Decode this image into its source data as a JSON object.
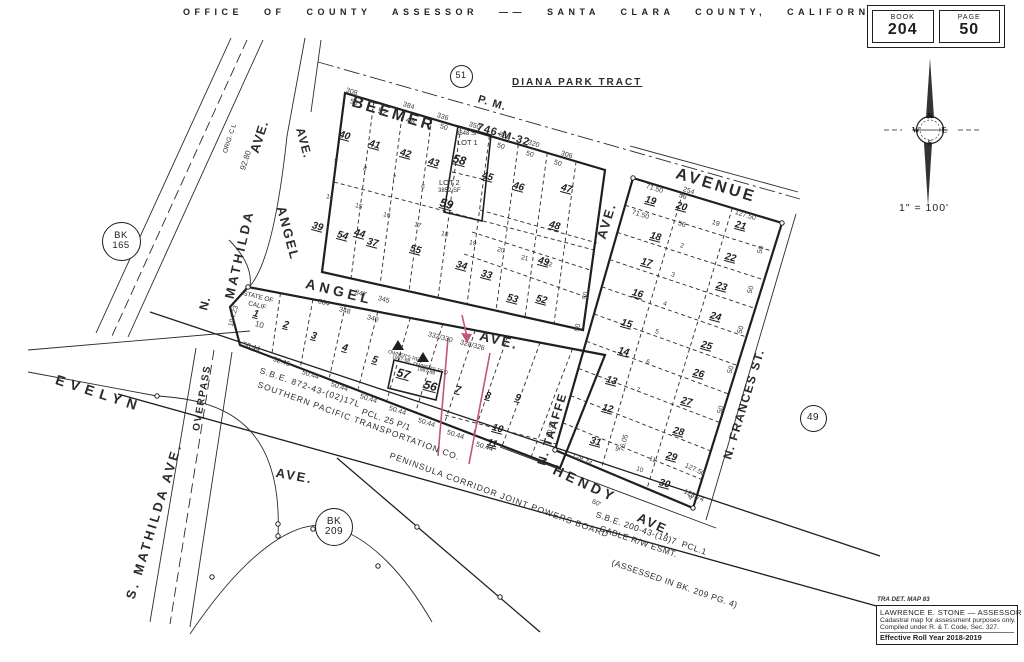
{
  "header": {
    "title": "OFFICE OF COUNTY ASSESSOR —— SANTA CLARA COUNTY, CALIFORNIA"
  },
  "book_page": {
    "book_label": "BOOK",
    "book_value": "204",
    "page_label": "PAGE",
    "page_value": "50"
  },
  "compass": {
    "letters": [
      "N",
      "E",
      "S",
      "W"
    ],
    "scale": "1\" = 100'"
  },
  "stamp": {
    "tra": "TRA DET. MAP 83",
    "line1": "LAWRENCE E. STONE — ASSESSOR",
    "line2": "Cadastral map for assessment purposes only.",
    "line3": "Compiled under R. & T. Code, Sec. 327.",
    "line4": "Effective Roll Year 2018-2019"
  },
  "colors": {
    "ink": "#1f1f1f",
    "accent": "#c2557f"
  },
  "map": {
    "streets": [
      {
        "t": "BEEMER",
        "x": 352,
        "y": 94,
        "r": 17,
        "s": 16,
        "ls": 3
      },
      {
        "t": "P. M.",
        "x": 478,
        "y": 94,
        "r": 17,
        "s": 11,
        "ls": 1
      },
      {
        "t": "746-M-32",
        "x": 477,
        "y": 122,
        "r": 17,
        "s": 11,
        "ls": 1
      },
      {
        "t": "DIANA PARK TRACT",
        "x": 512,
        "y": 78,
        "r": 0,
        "s": 10,
        "ls": 2,
        "u": 1
      },
      {
        "t": "AVENUE",
        "x": 676,
        "y": 166,
        "r": 17,
        "s": 16,
        "ls": 3
      },
      {
        "t": "AVE.",
        "x": 601,
        "y": 232,
        "r": -73,
        "s": 13,
        "ls": 2
      },
      {
        "t": "AVE.",
        "x": 300,
        "y": 122,
        "r": 75,
        "s": 12,
        "ls": 1
      },
      {
        "t": "ANGEL",
        "x": 281,
        "y": 200,
        "r": 75,
        "s": 13,
        "ls": 2
      },
      {
        "t": "ANGEL",
        "x": 306,
        "y": 276,
        "r": 14,
        "s": 14,
        "ls": 4
      },
      {
        "t": "AVE.",
        "x": 480,
        "y": 328,
        "r": 14,
        "s": 14,
        "ls": 2
      },
      {
        "t": "N.",
        "x": 203,
        "y": 304,
        "r": -75,
        "s": 12,
        "ls": 1
      },
      {
        "t": "MATHILDA",
        "x": 229,
        "y": 292,
        "r": -77,
        "s": 13,
        "ls": 3
      },
      {
        "t": "AVE.",
        "x": 254,
        "y": 146,
        "r": -72,
        "s": 13,
        "ls": 1
      },
      {
        "t": "EVELYN",
        "x": 56,
        "y": 372,
        "r": 18,
        "s": 14,
        "ls": 6
      },
      {
        "t": "S. MATHILDA AVE.",
        "x": 130,
        "y": 592,
        "r": -73,
        "s": 13,
        "ls": 3
      },
      {
        "t": "OVERPASS",
        "x": 197,
        "y": 426,
        "r": -80,
        "s": 10,
        "ls": 1.5
      },
      {
        "t": "AVE.",
        "x": 276,
        "y": 466,
        "r": 10,
        "s": 13,
        "ls": 2
      },
      {
        "t": "HENDY",
        "x": 554,
        "y": 462,
        "r": 25,
        "s": 14,
        "ls": 4
      },
      {
        "t": "AVE.",
        "x": 638,
        "y": 510,
        "r": 25,
        "s": 13,
        "ls": 2
      },
      {
        "t": "N. TAAFFE",
        "x": 541,
        "y": 459,
        "r": -73,
        "s": 12,
        "ls": 1.5
      },
      {
        "t": "N. FRANCES ST.",
        "x": 727,
        "y": 453,
        "r": -73,
        "s": 12,
        "ls": 1.5
      }
    ],
    "notes": [
      {
        "t": "S.B.E. 872-43-(02)17L",
        "x": 260,
        "y": 366,
        "r": 19,
        "s": 8.5,
        "ls": 1
      },
      {
        "t": "SOUTHERN PACIFIC TRANSPORTATION CO.",
        "x": 258,
        "y": 380,
        "r": 20,
        "s": 8.5,
        "ls": 1
      },
      {
        "t": "PCL. 25 P/1",
        "x": 362,
        "y": 407,
        "r": 19,
        "s": 8.5,
        "ls": 0.5
      },
      {
        "t": "PENINSULA CORRIDOR JOINT POWERS BOARD",
        "x": 390,
        "y": 451,
        "r": 20,
        "s": 8.5,
        "ls": 1
      },
      {
        "t": "S.B.E. 200-43-(18)7  PCL.1",
        "x": 596,
        "y": 510,
        "r": 19,
        "s": 8.5,
        "ls": 0.5
      },
      {
        "t": "CABLE R/W ESMT.",
        "x": 600,
        "y": 524,
        "r": 19,
        "s": 8.5,
        "ls": 0.5
      },
      {
        "t": "(ASSESSED IN BK. 209 PG. 4)",
        "x": 612,
        "y": 558,
        "r": 19,
        "s": 8.5,
        "ls": 0.5
      },
      {
        "t": "STATE OF",
        "x": 243,
        "y": 291,
        "r": 14,
        "s": 6.5
      },
      {
        "t": "CALIF",
        "x": 248,
        "y": 301,
        "r": 14,
        "s": 6.5
      },
      {
        "t": "OWNER'S REQ",
        "x": 388,
        "y": 350,
        "r": 15,
        "s": 5
      },
      {
        "t": "1987-88",
        "x": 392,
        "y": 355,
        "r": 15,
        "s": 5
      },
      {
        "t": "OWNER'S REQ",
        "x": 413,
        "y": 362,
        "r": 15,
        "s": 5
      },
      {
        "t": "1987-88",
        "x": 417,
        "y": 367,
        "r": 15,
        "s": 5
      },
      {
        "t": "LOT 1",
        "x": 457,
        "y": 139,
        "r": 0,
        "s": 7.5
      },
      {
        "t": "3648 SF",
        "x": 456,
        "y": 131,
        "r": 0,
        "s": 6
      },
      {
        "t": "LOT 2",
        "x": 439,
        "y": 179,
        "r": 0,
        "s": 7.5
      },
      {
        "t": "3852 SF",
        "x": 438,
        "y": 188,
        "r": 0,
        "s": 6
      },
      {
        "t": "ORIG. C L",
        "x": 226,
        "y": 150,
        "r": -72,
        "s": 6.5
      }
    ],
    "parcels": [
      {
        "t": "40",
        "x": 339,
        "y": 130
      },
      {
        "t": "41",
        "x": 369,
        "y": 139
      },
      {
        "t": "42",
        "x": 400,
        "y": 148
      },
      {
        "t": "43",
        "x": 428,
        "y": 157
      },
      {
        "t": "58",
        "x": 453,
        "y": 152,
        "s": 12
      },
      {
        "t": "45",
        "x": 482,
        "y": 171
      },
      {
        "t": "46",
        "x": 513,
        "y": 181
      },
      {
        "t": "47",
        "x": 561,
        "y": 183
      },
      {
        "t": "48",
        "x": 549,
        "y": 220
      },
      {
        "t": "49",
        "x": 538,
        "y": 256
      },
      {
        "t": "39",
        "x": 312,
        "y": 221
      },
      {
        "t": "54",
        "x": 337,
        "y": 230
      },
      {
        "t": "44",
        "x": 354,
        "y": 228
      },
      {
        "t": "37",
        "x": 367,
        "y": 237
      },
      {
        "t": "55",
        "x": 410,
        "y": 244
      },
      {
        "t": "34",
        "x": 456,
        "y": 260
      },
      {
        "t": "33",
        "x": 481,
        "y": 269
      },
      {
        "t": "53",
        "x": 507,
        "y": 293
      },
      {
        "t": "52",
        "x": 536,
        "y": 294
      },
      {
        "t": "59",
        "x": 440,
        "y": 196,
        "s": 12
      },
      {
        "t": "1",
        "x": 253,
        "y": 309
      },
      {
        "t": "2",
        "x": 283,
        "y": 320
      },
      {
        "t": "3",
        "x": 311,
        "y": 331
      },
      {
        "t": "4",
        "x": 342,
        "y": 343
      },
      {
        "t": "5",
        "x": 372,
        "y": 355
      },
      {
        "t": "57",
        "x": 397,
        "y": 366,
        "s": 12
      },
      {
        "t": "56",
        "x": 424,
        "y": 378,
        "s": 12
      },
      {
        "t": "7",
        "x": 455,
        "y": 385
      },
      {
        "t": "8",
        "x": 485,
        "y": 391
      },
      {
        "t": "9",
        "x": 515,
        "y": 393
      },
      {
        "t": "10",
        "x": 492,
        "y": 423
      },
      {
        "t": "11",
        "x": 487,
        "y": 438
      },
      {
        "t": "19",
        "x": 645,
        "y": 195
      },
      {
        "t": "20",
        "x": 676,
        "y": 201
      },
      {
        "t": "21",
        "x": 735,
        "y": 220
      },
      {
        "t": "18",
        "x": 650,
        "y": 231
      },
      {
        "t": "22",
        "x": 725,
        "y": 252
      },
      {
        "t": "17",
        "x": 641,
        "y": 257
      },
      {
        "t": "23",
        "x": 716,
        "y": 281
      },
      {
        "t": "16",
        "x": 632,
        "y": 288
      },
      {
        "t": "24",
        "x": 710,
        "y": 311
      },
      {
        "t": "15",
        "x": 621,
        "y": 318
      },
      {
        "t": "25",
        "x": 701,
        "y": 340
      },
      {
        "t": "14",
        "x": 618,
        "y": 346
      },
      {
        "t": "26",
        "x": 693,
        "y": 368
      },
      {
        "t": "13",
        "x": 606,
        "y": 375
      },
      {
        "t": "27",
        "x": 681,
        "y": 396
      },
      {
        "t": "12",
        "x": 602,
        "y": 403
      },
      {
        "t": "28",
        "x": 673,
        "y": 426
      },
      {
        "t": "31",
        "x": 590,
        "y": 436
      },
      {
        "t": "29",
        "x": 666,
        "y": 451
      },
      {
        "t": "30",
        "x": 659,
        "y": 478
      }
    ],
    "dims": [
      {
        "t": "308",
        "x": 346,
        "y": 87
      },
      {
        "t": "50",
        "x": 350,
        "y": 98
      },
      {
        "t": "52",
        "x": 378,
        "y": 106,
        "s": 8.5
      },
      {
        "t": "384",
        "x": 403,
        "y": 101
      },
      {
        "t": "48",
        "x": 406,
        "y": 115,
        "s": 8.5
      },
      {
        "t": "336",
        "x": 437,
        "y": 112
      },
      {
        "t": "50",
        "x": 440,
        "y": 123
      },
      {
        "t": "350",
        "x": 469,
        "y": 121
      },
      {
        "t": "336",
        "x": 499,
        "y": 131
      },
      {
        "t": "50",
        "x": 497,
        "y": 142
      },
      {
        "t": "320",
        "x": 528,
        "y": 139
      },
      {
        "t": "50",
        "x": 526,
        "y": 150
      },
      {
        "t": "306",
        "x": 561,
        "y": 150
      },
      {
        "t": "50",
        "x": 554,
        "y": 159
      },
      {
        "t": "254",
        "x": 683,
        "y": 186
      },
      {
        "t": "71.50",
        "x": 646,
        "y": 183
      },
      {
        "t": "56",
        "x": 679,
        "y": 192
      },
      {
        "t": "71.50",
        "x": 632,
        "y": 209
      },
      {
        "t": "127.50",
        "x": 735,
        "y": 209
      },
      {
        "t": "56",
        "x": 678,
        "y": 220
      },
      {
        "t": "19",
        "x": 712,
        "y": 219
      },
      {
        "t": "332/330",
        "x": 428,
        "y": 331,
        "r": 15
      },
      {
        "t": "328/326",
        "x": 460,
        "y": 339,
        "r": 15
      },
      {
        "t": "384",
        "x": 318,
        "y": 298,
        "r": 15
      },
      {
        "t": "348",
        "x": 339,
        "y": 306,
        "r": 15
      },
      {
        "t": "340",
        "x": 367,
        "y": 314,
        "r": 15
      },
      {
        "t": "347",
        "x": 355,
        "y": 289,
        "r": 15
      },
      {
        "t": "345",
        "x": 378,
        "y": 295,
        "r": 15
      },
      {
        "t": "50.44",
        "x": 243,
        "y": 341,
        "r": 18
      },
      {
        "t": "52.46",
        "x": 273,
        "y": 356,
        "r": 18
      },
      {
        "t": "50.44",
        "x": 302,
        "y": 369,
        "r": 18
      },
      {
        "t": "50.44",
        "x": 331,
        "y": 381,
        "r": 18
      },
      {
        "t": "50.44",
        "x": 360,
        "y": 393,
        "r": 18
      },
      {
        "t": "50.44",
        "x": 389,
        "y": 405,
        "r": 18
      },
      {
        "t": "50.44",
        "x": 418,
        "y": 417,
        "r": 18
      },
      {
        "t": "50.44",
        "x": 447,
        "y": 429,
        "r": 18
      },
      {
        "t": "50.44",
        "x": 476,
        "y": 441,
        "r": 18
      },
      {
        "t": "104.23",
        "x": 231,
        "y": 323,
        "r": -75
      },
      {
        "t": "92.80",
        "x": 243,
        "y": 166,
        "r": -72,
        "s": 8
      },
      {
        "t": "10",
        "x": 255,
        "y": 320,
        "s": 8,
        "r": 15
      },
      {
        "t": "128.74",
        "x": 572,
        "y": 452,
        "r": 25
      },
      {
        "t": "76.05",
        "x": 622,
        "y": 448,
        "r": -75
      },
      {
        "t": "127.50",
        "x": 685,
        "y": 462,
        "r": 25
      },
      {
        "t": "128.74",
        "x": 684,
        "y": 488,
        "r": 25
      },
      {
        "t": "60'",
        "x": 592,
        "y": 498,
        "r": 25
      },
      {
        "t": "47",
        "x": 690,
        "y": 496,
        "r": -60
      },
      {
        "t": "60.91",
        "x": 549,
        "y": 434,
        "r": -75
      },
      {
        "t": "50",
        "x": 585,
        "y": 296,
        "r": -75
      },
      {
        "t": "50",
        "x": 577,
        "y": 328,
        "r": -75
      },
      {
        "t": "50",
        "x": 760,
        "y": 250,
        "r": -73
      },
      {
        "t": "50",
        "x": 750,
        "y": 290,
        "r": -73
      },
      {
        "t": "50",
        "x": 740,
        "y": 330,
        "r": -73
      },
      {
        "t": "50",
        "x": 730,
        "y": 370,
        "r": -73
      },
      {
        "t": "50",
        "x": 720,
        "y": 410,
        "r": -73
      },
      {
        "t": "9",
        "x": 334,
        "y": 158,
        "s": 6.5,
        "r": 15
      },
      {
        "t": "8",
        "x": 363,
        "y": 166,
        "s": 6.5,
        "r": 15
      },
      {
        "t": "7",
        "x": 392,
        "y": 175,
        "s": 6.5,
        "r": 15
      },
      {
        "t": "6",
        "x": 421,
        "y": 184,
        "s": 6.5,
        "r": 15
      },
      {
        "t": "14",
        "x": 326,
        "y": 194,
        "s": 6.5,
        "r": 15
      },
      {
        "t": "15",
        "x": 355,
        "y": 203,
        "s": 6.5,
        "r": 15
      },
      {
        "t": "16",
        "x": 383,
        "y": 212,
        "s": 6.5,
        "r": 15
      },
      {
        "t": "17",
        "x": 414,
        "y": 222,
        "s": 6.5,
        "r": 15
      },
      {
        "t": "18",
        "x": 441,
        "y": 231,
        "s": 6.5,
        "r": 15
      },
      {
        "t": "19",
        "x": 469,
        "y": 240,
        "s": 6.5,
        "r": 15
      },
      {
        "t": "20",
        "x": 497,
        "y": 247,
        "s": 6.5,
        "r": 15
      },
      {
        "t": "21",
        "x": 521,
        "y": 255,
        "s": 6.5,
        "r": 15
      },
      {
        "t": "22",
        "x": 545,
        "y": 261,
        "s": 6.5,
        "r": 15
      },
      {
        "t": "2",
        "x": 680,
        "y": 243,
        "s": 6.5,
        "r": 17
      },
      {
        "t": "3",
        "x": 671,
        "y": 272,
        "s": 6.5,
        "r": 17
      },
      {
        "t": "4",
        "x": 663,
        "y": 301,
        "s": 6.5,
        "r": 17
      },
      {
        "t": "5",
        "x": 655,
        "y": 329,
        "s": 6.5,
        "r": 17
      },
      {
        "t": "6",
        "x": 646,
        "y": 359,
        "s": 6.5,
        "r": 17
      },
      {
        "t": "7",
        "x": 636,
        "y": 387,
        "s": 6.5,
        "r": 17
      },
      {
        "t": "9",
        "x": 615,
        "y": 446,
        "s": 6.5,
        "r": 20
      },
      {
        "t": "10",
        "x": 636,
        "y": 466,
        "s": 6.5,
        "r": 20
      },
      {
        "t": "11",
        "x": 649,
        "y": 456,
        "s": 6.5,
        "r": 20
      }
    ],
    "circles": [
      {
        "lines": [
          "51"
        ],
        "x": 460,
        "y": 75,
        "d": 21,
        "fs": 9
      },
      {
        "lines": [
          "49"
        ],
        "x": 812,
        "y": 417,
        "d": 25,
        "fs": 10
      },
      {
        "lines": [
          "BK",
          "165"
        ],
        "x": 120,
        "y": 240,
        "d": 37,
        "fs": 9.5
      },
      {
        "lines": [
          "BK",
          "209"
        ],
        "x": 333,
        "y": 526,
        "d": 36,
        "fs": 10
      }
    ]
  }
}
